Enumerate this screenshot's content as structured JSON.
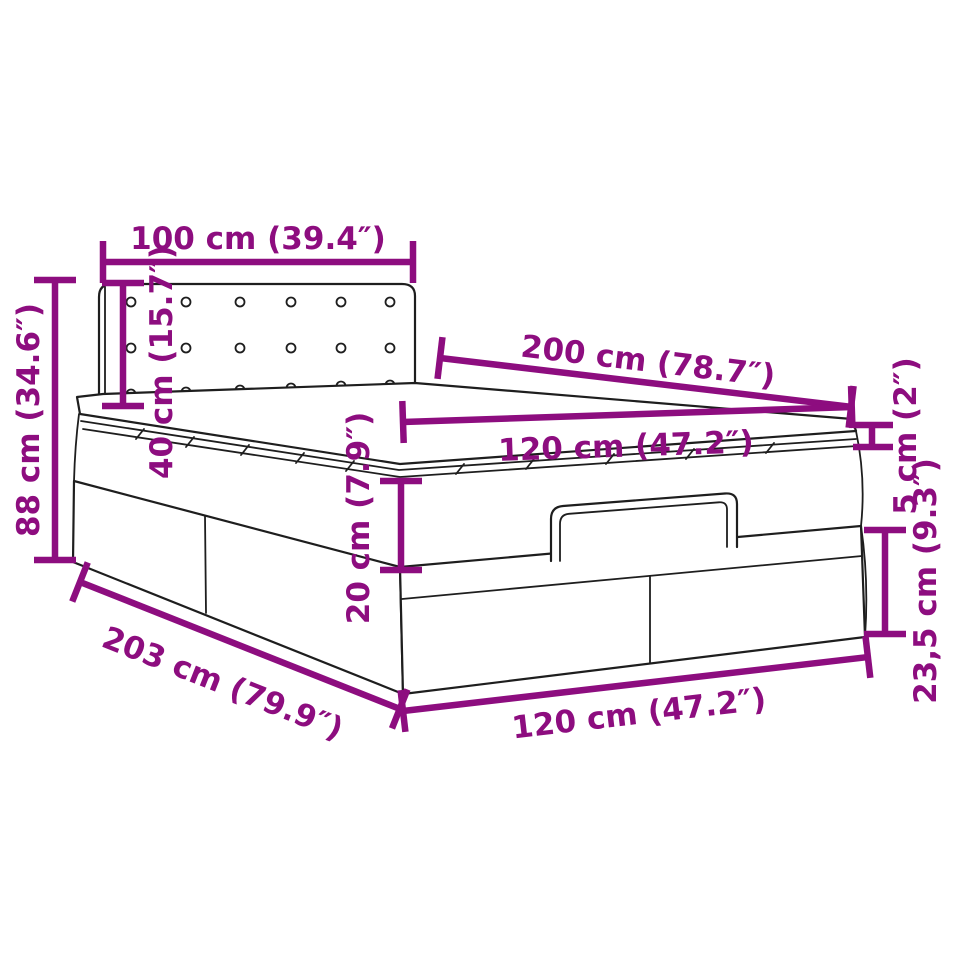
{
  "diagram": {
    "subject": "ottoman-storage-bed-dimension-drawing",
    "accent_color": "#8d0d7f",
    "outline_color": "#1e1e1e",
    "background_color": "#ffffff",
    "dimensions": {
      "headboard_width": {
        "label": "100 cm (39.4″)",
        "cm": 100,
        "inches": 39.4
      },
      "overall_height": {
        "label": "88 cm (34.6″)",
        "cm": 88,
        "inches": 34.6
      },
      "headboard_height": {
        "label": "40 cm (15.7″)",
        "cm": 40,
        "inches": 15.7
      },
      "bed_length": {
        "label": "200 cm (78.7″)",
        "cm": 200,
        "inches": 78.7
      },
      "mattress_width_top": {
        "label": "120 cm (47.2″)",
        "cm": 120,
        "inches": 47.2
      },
      "mattress_thickness": {
        "label": "20 cm (7.9″)",
        "cm": 20,
        "inches": 7.9
      },
      "topper_thickness": {
        "label": "5 cm (2″)",
        "cm": 5,
        "inches": 2
      },
      "base_height": {
        "label": "23,5 cm (9.3″)",
        "cm": 23.5,
        "inches": 9.3
      },
      "base_length": {
        "label": "203 cm (79.9″)",
        "cm": 203,
        "inches": 79.9
      },
      "base_width": {
        "label": "120 cm (47.2″)",
        "cm": 120,
        "inches": 47.2
      }
    }
  }
}
